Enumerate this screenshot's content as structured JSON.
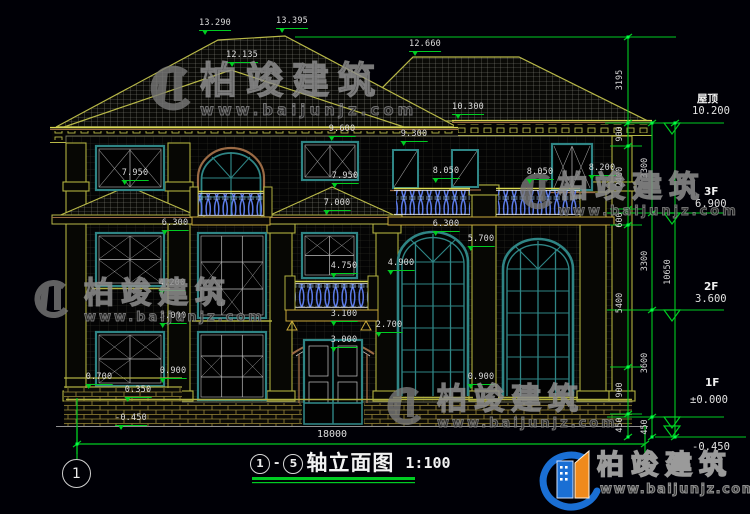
{
  "colors": {
    "background": "#000006",
    "annotation_green": "#00cc22",
    "window_teal": "#2f8585",
    "balustrade_blue": "#5b7ae8",
    "trim_olive": "#b0b040",
    "trim_brown": "#9a6a45",
    "text_white": "#dcdcdc",
    "logo_blue": "#1a6fd4",
    "logo_orange": "#ef8a1c"
  },
  "dims": [
    "13.290",
    "13.395",
    "12.135",
    "12.660",
    "10.300",
    "9.600",
    "9.300",
    "7.950",
    "7.950",
    "7.000",
    "8.050",
    "8.050",
    "8.200",
    "6.300",
    "6.300",
    "5.700",
    "4.900",
    "4.750",
    "4.200",
    "3.100",
    "3.000",
    "3.000",
    "2.700",
    "0.900",
    "0.900",
    "0.700",
    "0.350",
    "-0.450"
  ],
  "levels": [
    {
      "name": "屋顶",
      "value": "10.200"
    },
    {
      "name": "3F",
      "value": "6.900"
    },
    {
      "name": "2F",
      "value": "3.600"
    },
    {
      "name": "1F",
      "value": "±0.000"
    },
    {
      "name": "",
      "value": "-0.450"
    }
  ],
  "chains": {
    "inner": [
      "3195",
      "900",
      "2400",
      "600",
      "5400",
      "900",
      "450"
    ],
    "middle": [
      "3300",
      "3300",
      "3600",
      "450"
    ],
    "outer": [
      "10650"
    ]
  },
  "bottom": {
    "total_width": "18000",
    "axis_bubble": "1"
  },
  "title": {
    "axis_start": "1",
    "separator": "-",
    "axis_end": "5",
    "name": "轴立面图",
    "scale": "1:100"
  },
  "watermark": {
    "brand": "柏竣建筑",
    "url": "www.baijunjz.com"
  },
  "footer_logo": {
    "brand": "柏竣建筑",
    "url": "www.baijunjz.com"
  }
}
